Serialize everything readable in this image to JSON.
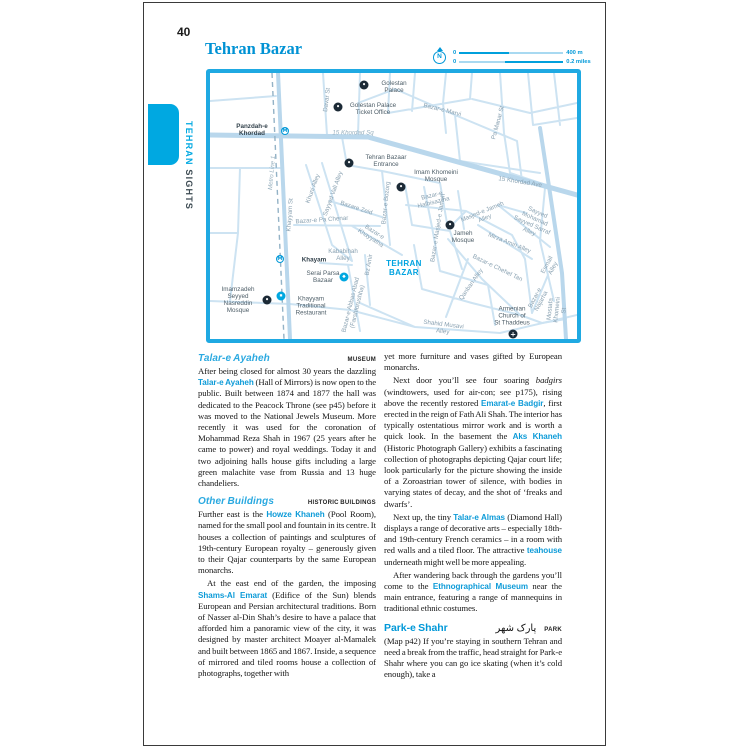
{
  "colors": {
    "accent_blue": "#00a8e1",
    "map_border_blue": "#1fa9e2",
    "street_blue": "#c9e1f1",
    "heading_blue": "#0098d8",
    "title_blue": "#0092d4",
    "street_label_gray": "#8aa2b2",
    "poi_label_gray": "#4e5e68"
  },
  "header": {
    "page_number": "40",
    "tab_primary": "TEHRAN",
    "tab_secondary": " SIGHTS",
    "map_title": "Tehran Bazar"
  },
  "scale": {
    "north": "N",
    "metric_zero": "0",
    "metric_end": "400 m",
    "imperial_zero": "0",
    "imperial_end": "0.2 miles"
  },
  "map": {
    "marker_glyphs": {
      "poi": "•",
      "metro": "M",
      "church": "+",
      "shop": "◆",
      "rest": "▪"
    },
    "markers": [
      {
        "x": 154,
        "y": 12,
        "k": "poi"
      },
      {
        "x": 128,
        "y": 34,
        "k": "poi"
      },
      {
        "x": 139,
        "y": 90,
        "k": "poi"
      },
      {
        "x": 191,
        "y": 114,
        "k": "poi"
      },
      {
        "x": 240,
        "y": 152,
        "k": "poi"
      },
      {
        "x": 57,
        "y": 227,
        "k": "poi"
      },
      {
        "x": 303,
        "y": 261,
        "k": "church"
      },
      {
        "x": 75,
        "y": 58,
        "k": "metro"
      },
      {
        "x": 70,
        "y": 186,
        "k": "metro"
      },
      {
        "x": 134,
        "y": 204,
        "k": "shop"
      },
      {
        "x": 71,
        "y": 223,
        "k": "rest"
      }
    ],
    "labels": [
      {
        "t": "Davar St",
        "x": 118,
        "y": 27,
        "r": -83,
        "c": "st"
      },
      {
        "t": "Golestan\nPalace",
        "x": 184,
        "y": 14,
        "r": 0,
        "c": "poi"
      },
      {
        "t": "Golestan Palace\nTicket Office",
        "x": 163,
        "y": 36,
        "r": 0,
        "c": "poi"
      },
      {
        "t": "Panzdah-e\nKhordad",
        "x": 42,
        "y": 57,
        "r": 0,
        "c": "stn"
      },
      {
        "t": "15 Khordad Sq",
        "x": 143,
        "y": 61,
        "r": 0,
        "c": "st it"
      },
      {
        "t": "Bazar-e Marvi",
        "x": 232,
        "y": 38,
        "r": 14,
        "c": "st"
      },
      {
        "t": "Pa Manar St",
        "x": 289,
        "y": 50,
        "r": -75,
        "c": "st"
      },
      {
        "t": "15 Khordad Ave",
        "x": 310,
        "y": 110,
        "r": 9,
        "c": "st"
      },
      {
        "t": "Metro Line 1",
        "x": 63,
        "y": 100,
        "r": -85,
        "c": "st it"
      },
      {
        "t": "Khayyam St",
        "x": 81,
        "y": 142,
        "r": -86,
        "c": "st"
      },
      {
        "t": "Khuni Alley",
        "x": 104,
        "y": 116,
        "r": -70,
        "c": "st"
      },
      {
        "t": "Sayyed Vali Alley",
        "x": 124,
        "y": 121,
        "r": -70,
        "c": "st"
      },
      {
        "t": "Tehran Bazaar\nEntrance",
        "x": 176,
        "y": 88,
        "r": 0,
        "c": "poi"
      },
      {
        "t": "Imam Khomeini\nMosque",
        "x": 226,
        "y": 103,
        "r": 0,
        "c": "poi"
      },
      {
        "t": "Bazar-e\nHalbisaz-ha",
        "x": 223,
        "y": 127,
        "r": -14,
        "c": "st"
      },
      {
        "t": "Bazare Zeid",
        "x": 146,
        "y": 136,
        "r": 18,
        "c": "st"
      },
      {
        "t": "Bazar-e Bozorg",
        "x": 177,
        "y": 130,
        "r": -84,
        "c": "st"
      },
      {
        "t": "Bazar-e Pa Chenar",
        "x": 112,
        "y": 148,
        "r": -4,
        "c": "st"
      },
      {
        "t": "Bazar-e\nKhayyatha",
        "x": 162,
        "y": 163,
        "r": 33,
        "c": "st"
      },
      {
        "t": "Kababihah\nAlley",
        "x": 133,
        "y": 183,
        "r": 0,
        "c": "st"
      },
      {
        "t": "Bz Amir",
        "x": 160,
        "y": 192,
        "r": -80,
        "c": "st"
      },
      {
        "t": "TEHRAN\nBAZAR",
        "x": 194,
        "y": 196,
        "r": 0,
        "c": "area"
      },
      {
        "t": "Khayam",
        "x": 104,
        "y": 187,
        "r": 0,
        "c": "stn"
      },
      {
        "t": "Serai Parsa\nBazaar",
        "x": 113,
        "y": 204,
        "r": 0,
        "c": "poi"
      },
      {
        "t": "Khayyam\nTraditional\nRestaurant",
        "x": 101,
        "y": 233,
        "r": 0,
        "c": "poi"
      },
      {
        "t": "Imamzadeh\nSeyyed\nNasreddin\nMosque",
        "x": 28,
        "y": 227,
        "r": 0,
        "c": "poi"
      },
      {
        "t": "Bazar-e Abbas Abad\n(Farshforushha)",
        "x": 145,
        "y": 233,
        "r": -76,
        "c": "st"
      },
      {
        "t": "Shahid Musavi\nAlley",
        "x": 233,
        "y": 256,
        "r": 7,
        "c": "st"
      },
      {
        "t": "Jameh\nMosque",
        "x": 253,
        "y": 164,
        "r": 0,
        "c": "poi"
      },
      {
        "t": "Bazar-e Masjed-e Jameh",
        "x": 229,
        "y": 155,
        "r": -81,
        "c": "st"
      },
      {
        "t": "Masjed-e Jameh\nAlley",
        "x": 274,
        "y": 143,
        "r": -22,
        "c": "st"
      },
      {
        "t": "Sayyed Mohamad\nSayyed Sarraf Alley",
        "x": 323,
        "y": 150,
        "r": 24,
        "c": "st"
      },
      {
        "t": "Mirza Amin Alley",
        "x": 299,
        "y": 171,
        "r": 22,
        "c": "st"
      },
      {
        "t": "Bazar-e Chehel Tan",
        "x": 287,
        "y": 196,
        "r": 26,
        "c": "st"
      },
      {
        "t": "Qanban Alley",
        "x": 262,
        "y": 212,
        "r": -55,
        "c": "st"
      },
      {
        "t": "Esmail Alley",
        "x": 341,
        "y": 194,
        "r": -62,
        "c": "st"
      },
      {
        "t": "Bazar-e\nNajarha",
        "x": 329,
        "y": 227,
        "r": -62,
        "c": "st"
      },
      {
        "t": "Mostafa\nKhomeini St",
        "x": 348,
        "y": 237,
        "r": -84,
        "c": "st"
      },
      {
        "t": "Armenian\nChurch of\nSt Thaddeus",
        "x": 302,
        "y": 243,
        "r": 0,
        "c": "poi"
      }
    ]
  },
  "articles": {
    "left": [
      {
        "h": "Talar-e Ayaheh",
        "cat": "MUSEUM"
      },
      {
        "p": [
          {
            "t": "After being closed for almost 30 years the dazzling "
          },
          {
            "t": "Talar-e Ayaheh",
            "s": "bb"
          },
          {
            "t": " (Hall of Mirrors) is now open to the public. Built between 1874 and 1877 the hall was dedicated to the Peacock Throne (see p45) before it was moved to the National Jewels Museum. More recently it was used for the coronation of Mohammad Reza Shah in 1967 (25 years after he came to power) and royal weddings. Today it and two adjoining halls house gifts including a large green malachite vase from Russia and 13 huge chandeliers."
          }
        ]
      },
      {
        "h": "Other Buildings",
        "cat": "HISTORIC BUILDINGS"
      },
      {
        "p": [
          {
            "t": "Further east is the "
          },
          {
            "t": "Howze Khaneh",
            "s": "bb"
          },
          {
            "t": " (Pool Room), named for the small pool and fountain in its centre. It houses a collection of paintings and sculptures of 19th-century European royalty – generously given to their Qajar counterparts by the same European monarchs."
          }
        ]
      },
      {
        "ind": true,
        "p": [
          {
            "t": "At the east end of the garden, the imposing "
          },
          {
            "t": "Shams-Al Emarat",
            "s": "bb"
          },
          {
            "t": " (Edifice of the Sun) blends European and Persian architectural traditions. Born of Nasser al-Din Shah’s desire to have a palace that afforded him a panoramic view of the city, it was designed by master architect Moayer al-Mamalek and built between 1865 and 1867. Inside, a sequence of mirrored and tiled rooms house a collection of photographs, together with"
          }
        ]
      }
    ],
    "right": [
      {
        "p": [
          {
            "t": "yet more furniture and vases gifted by European monarchs."
          }
        ]
      },
      {
        "ind": true,
        "p": [
          {
            "t": "Next door you’ll see four soaring "
          },
          {
            "t": "badgirs",
            "s": "i"
          },
          {
            "t": " (windtowers, used for air-con; see p175), rising above the recently restored "
          },
          {
            "t": "Emarat-e Badgir",
            "s": "bb"
          },
          {
            "t": ", first erected in the reign of Fath Ali Shah. The interior has typically ostentatious mirror work and is worth a quick look. In the basement the "
          },
          {
            "t": "Aks Khaneh",
            "s": "bb"
          },
          {
            "t": " (Historic Photograph Gallery) exhibits a fascinating collection of photographs depicting Qajar court life; look particularly for the picture showing the inside of a Zoroastrian tower of silence, with bodies in varying states of decay, and the shot of ‘freaks and dwarfs’."
          }
        ]
      },
      {
        "ind": true,
        "p": [
          {
            "t": "Next up, the tiny "
          },
          {
            "t": "Talar-e Almas",
            "s": "bb"
          },
          {
            "t": " (Diamond Hall) displays a range of decorative arts – especially 18th- and 19th-century French ceramics – in a room with red walls and a tiled floor. The attractive "
          },
          {
            "t": "teahouse",
            "s": "bb"
          },
          {
            "t": " underneath might well be more appealing."
          }
        ]
      },
      {
        "ind": true,
        "p": [
          {
            "t": "After wandering back through the gardens you’ll come to the "
          },
          {
            "t": "Ethnographical Museum",
            "s": "bb"
          },
          {
            "t": " near the main entrance, featuring a range of mannequins in traditional ethnic costumes."
          }
        ]
      },
      {
        "h2": "Park-e Shahr",
        "farsi": "پارک شهر",
        "cat": "PARK"
      },
      {
        "p": [
          {
            "t": "(Map p42) If you’re staying in southern Tehran and need a break from the traffic, head straight for Park-e Shahr where you can go ice skating (when it’s cold enough), take a"
          }
        ]
      }
    ]
  }
}
